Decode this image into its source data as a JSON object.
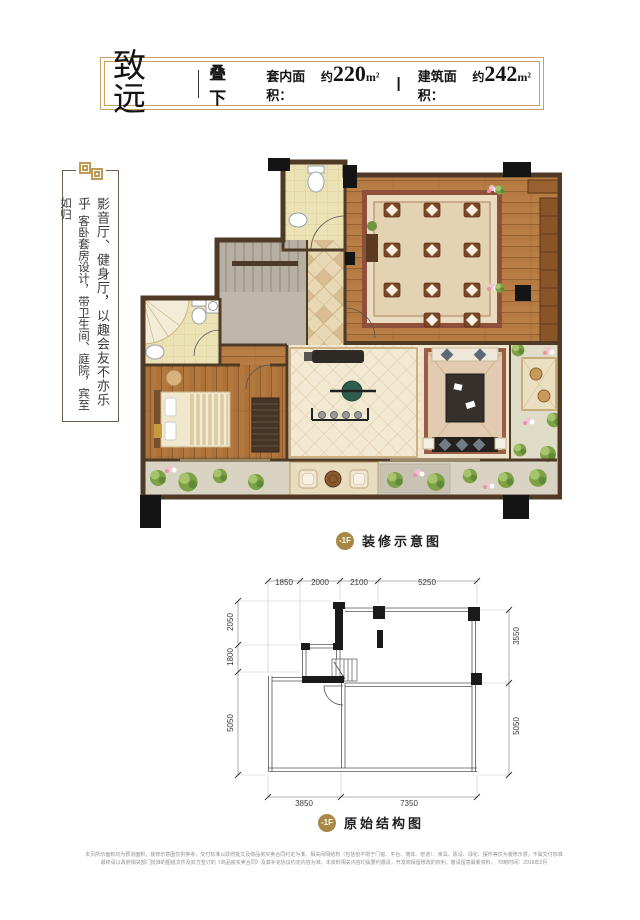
{
  "header": {
    "title": "致远",
    "divider": "|",
    "subtitle": "叠下",
    "area1_label": "套内面积：",
    "area1_approx": "约",
    "area1_num": "220",
    "area1_unit": "m²",
    "separator": "|",
    "area2_label": "建筑面积：",
    "area2_approx": "约",
    "area2_num": "242",
    "area2_unit": "m²"
  },
  "slogan": {
    "column1": "影音厅、健身厅，以趣会友不亦乐乎",
    "column2": "客卧套房设计，带卫生间、庭院，宾至如归"
  },
  "render_plan": {
    "badge": "-1F",
    "caption": "装修示意图"
  },
  "structure_plan": {
    "badge": "-1F",
    "caption": "原始结构图",
    "dims_top": [
      "1850",
      "2000",
      "2100",
      "5250"
    ],
    "dims_left": [
      "2050",
      "1800",
      "5050"
    ],
    "dims_right": [
      "3550",
      "5050"
    ],
    "dims_bottom": [
      "3850",
      "7350"
    ]
  },
  "footnote": {
    "line1": "本页所示面积均为预测面积，装修示意图仅供参考，交付标准以政府批文及商品房买卖合同约定为准。相关间隔结构（包括但不限于门窗、平台、墙体、管道）、家具、陈设、绿化、摆件等仅为装修示意，不属交付标准",
    "line2": "最终请以政府相关部门批准的图纸文件及双方签订的《商品房买卖合同》及其补充协议约定内容为准。本资料相关内容均属要约邀请，开发商保留修改的权利，敬请留意最新资料。　印制时间：2019年2月"
  },
  "palette": {
    "gold": "#a98845",
    "frame_gold": "#c8a45e",
    "wall_brown": "#4f3a26",
    "wood": "#b47a41",
    "ink": "#1f1f1f"
  }
}
